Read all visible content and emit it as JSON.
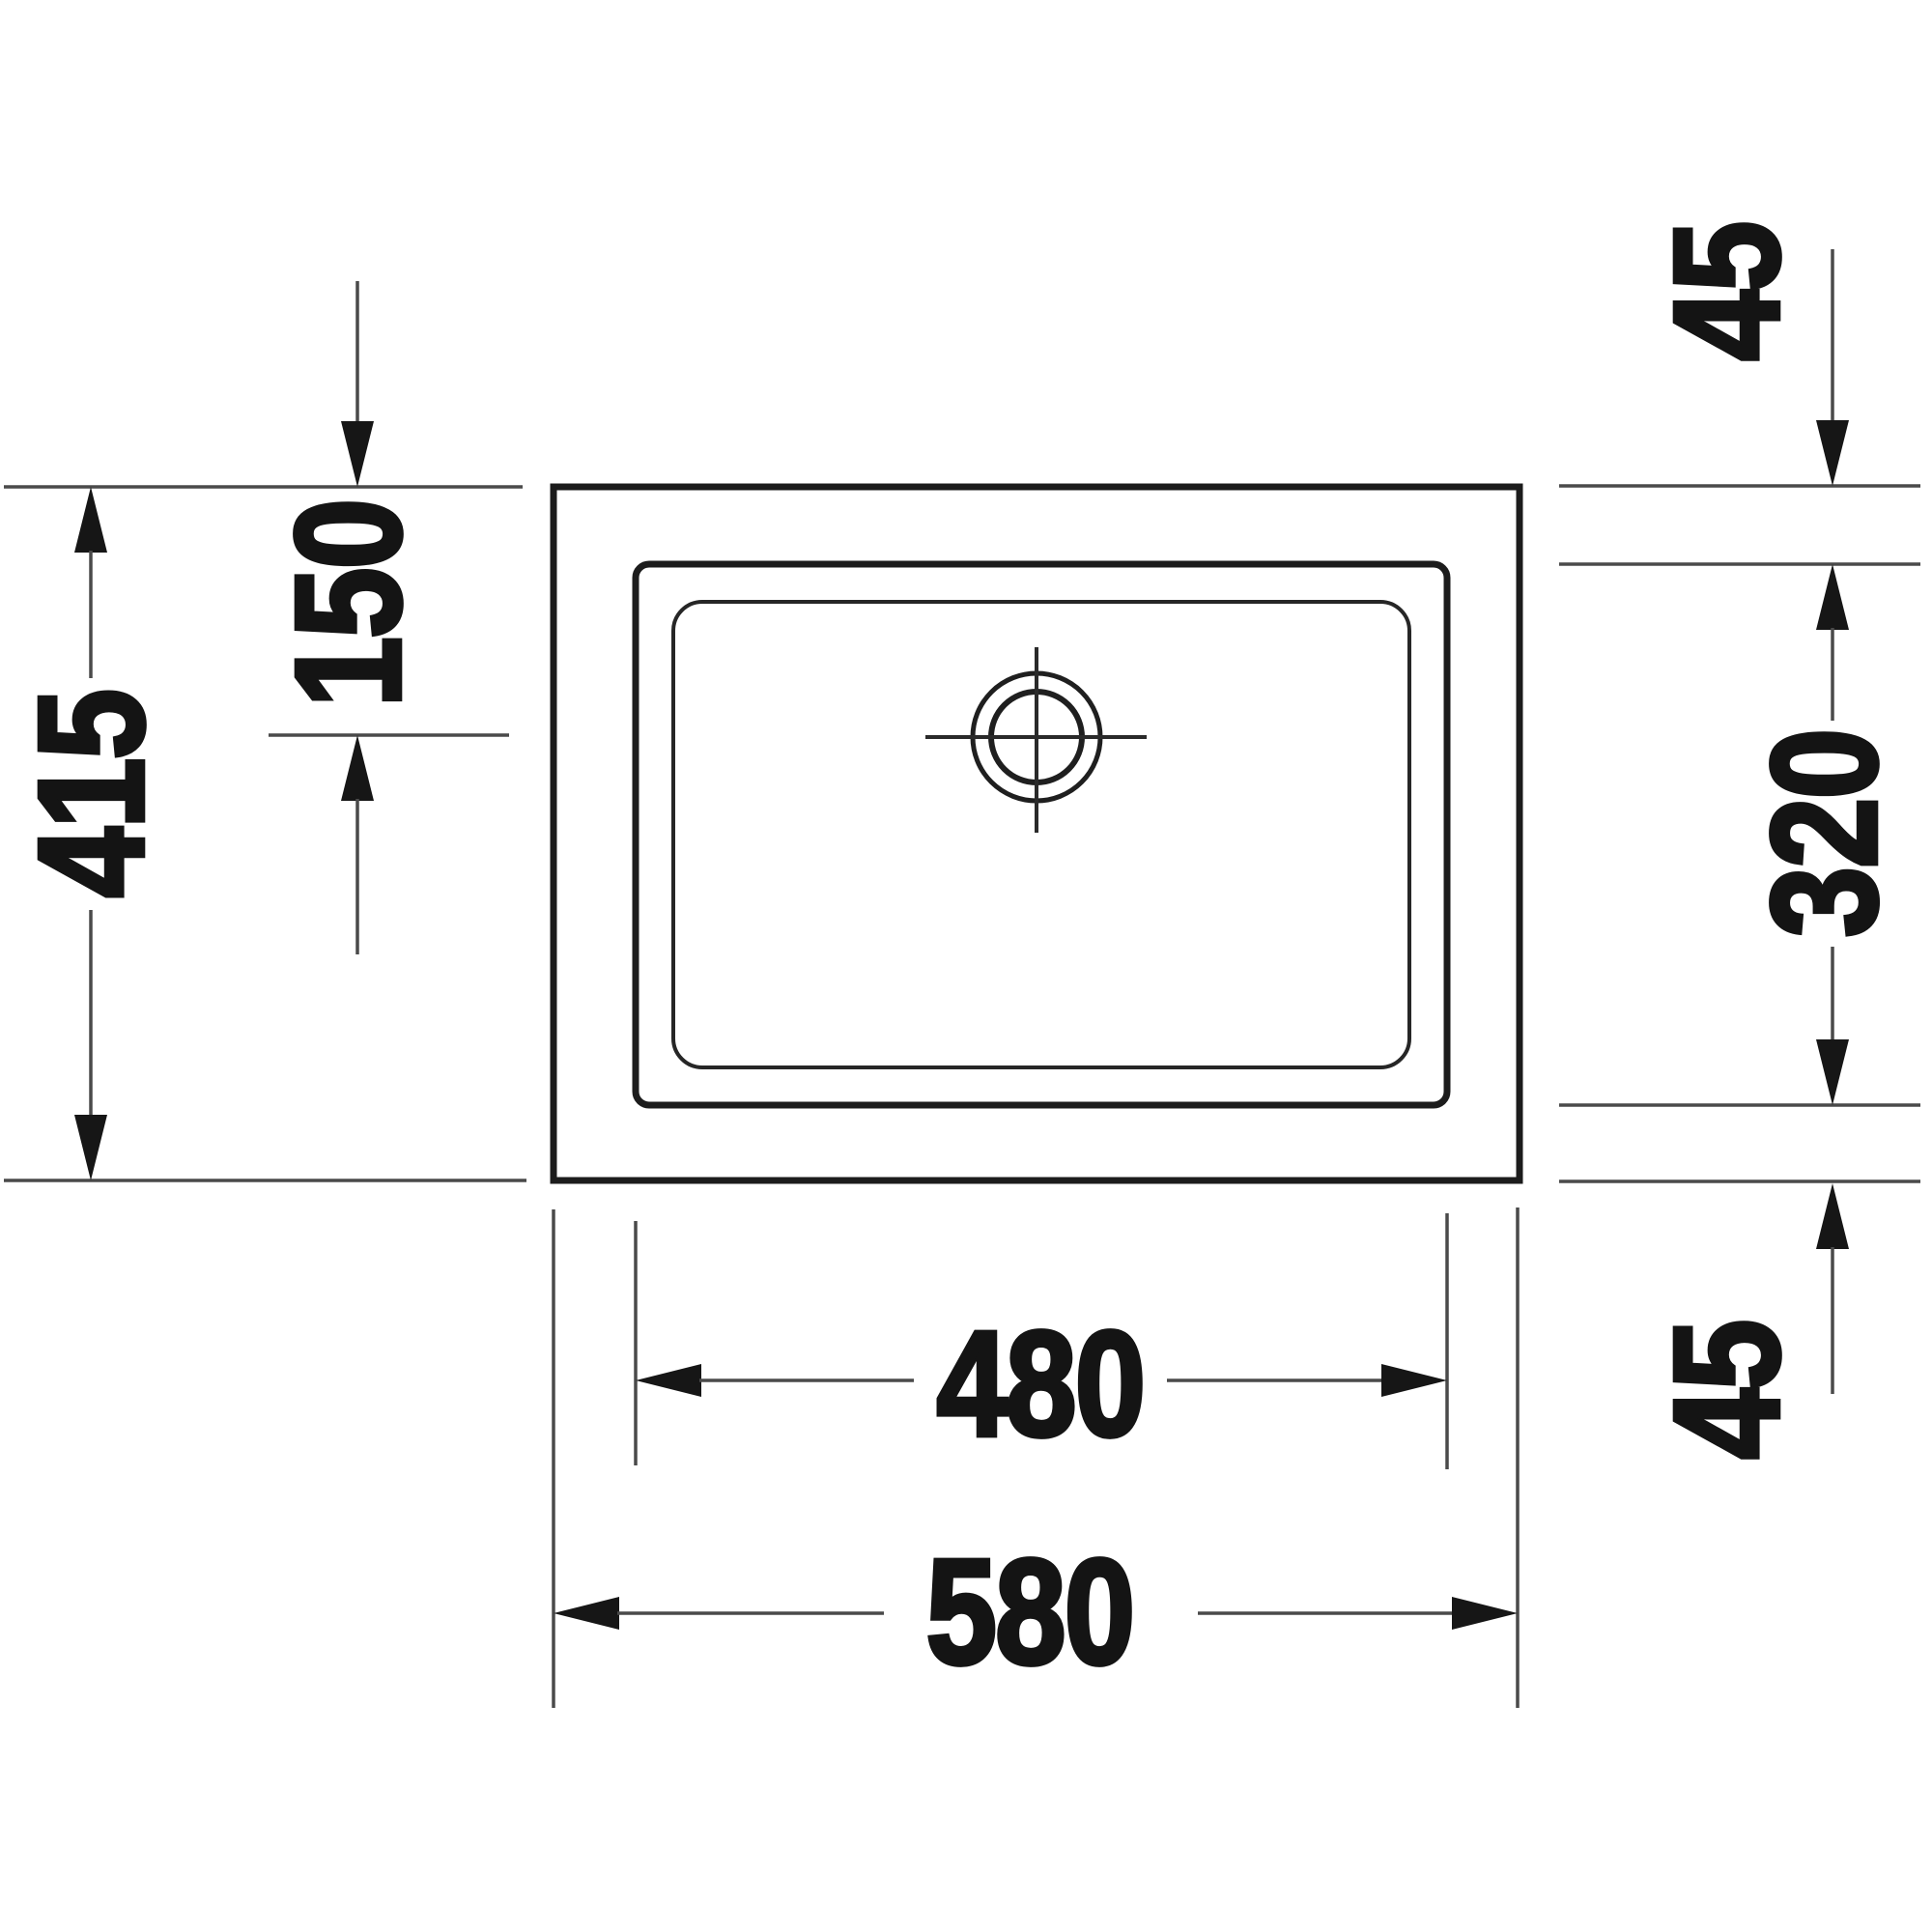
{
  "diagram": {
    "kind": "technical-dimension-drawing",
    "subject": "rectangular basin top view with drain and dimension lines",
    "background": "#ffffff",
    "outline_ink": "#1c1c1c",
    "dimension_ink": "#4a4a4a",
    "label_ink": "#141414",
    "labels": {
      "overall_height": "415",
      "drain_offset_from_top": "150",
      "top_margin": "45",
      "basin_inner_height": "320",
      "bottom_margin": "45",
      "basin_inner_width": "480",
      "overall_width": "580"
    }
  }
}
